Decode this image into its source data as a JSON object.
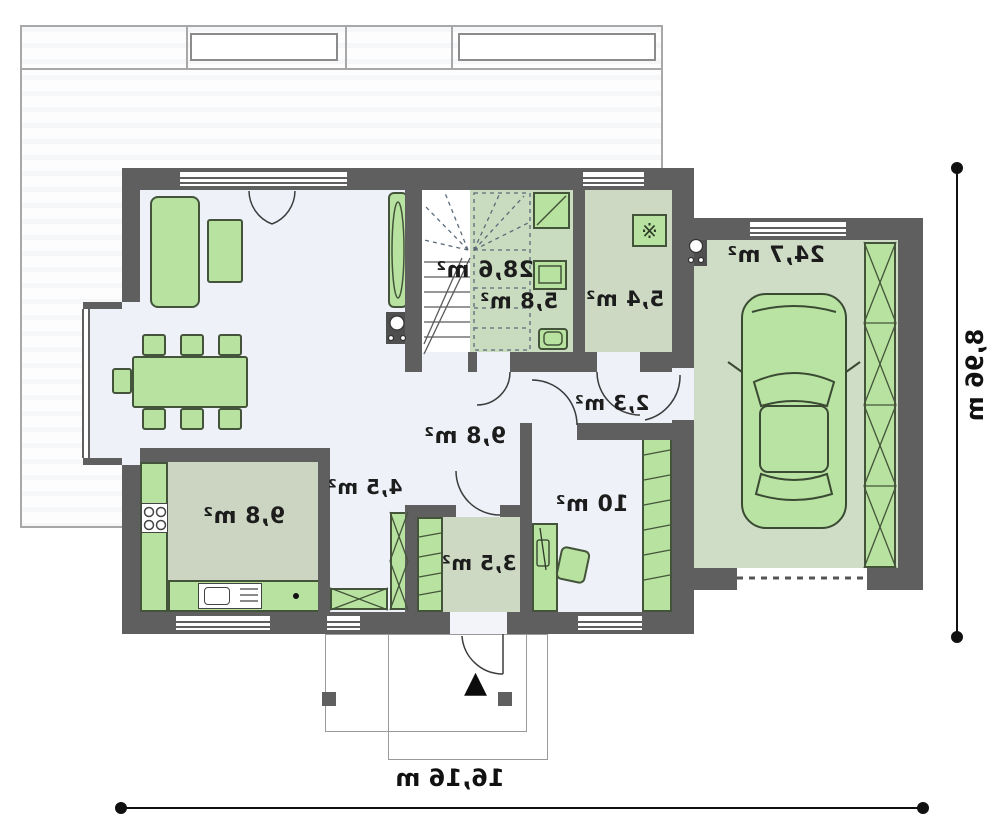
{
  "rooms": {
    "living": {
      "label": "28,6 m²"
    },
    "bath": {
      "label": "5,8 m²"
    },
    "utility": {
      "label": "5,4 m²"
    },
    "garage": {
      "label": "24,7 m²"
    },
    "hall_small": {
      "label": "2,3 m²"
    },
    "hall": {
      "label": "9,8 m²"
    },
    "kitchen": {
      "label": "9,8 m²"
    },
    "wardrobe": {
      "label": "4,5 m²"
    },
    "vestibule": {
      "label": "3,5 m²"
    },
    "office": {
      "label": "10 m²"
    }
  },
  "dimensions": {
    "overall_width": "16,16 m",
    "overall_height": "8,96 m"
  },
  "icons": {
    "boiler": "※",
    "entrance_arrow": "▲"
  },
  "colors": {
    "wall": "#5f5f5f",
    "floor-light": "#eef1f8",
    "floor-sage": "#cdd9c3",
    "furn": "#b7e2a0",
    "furn-border": "#44543a",
    "ink": "#1c1c1c",
    "thin": "#9a9a9a"
  }
}
